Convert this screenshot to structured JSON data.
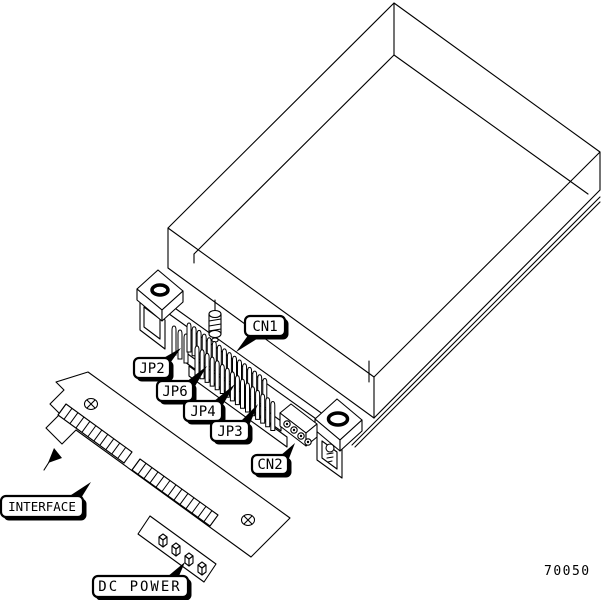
{
  "figure": {
    "number": "70050",
    "callouts": {
      "cn1": "CN1",
      "jp2": "JP2",
      "jp6": "JP6",
      "jp4": "JP4",
      "jp3": "JP3",
      "cn2": "CN2",
      "interface": "INTERFACE",
      "dc_power": "DC POWER"
    },
    "colors": {
      "line": "#000000",
      "background": "#ffffff"
    }
  }
}
